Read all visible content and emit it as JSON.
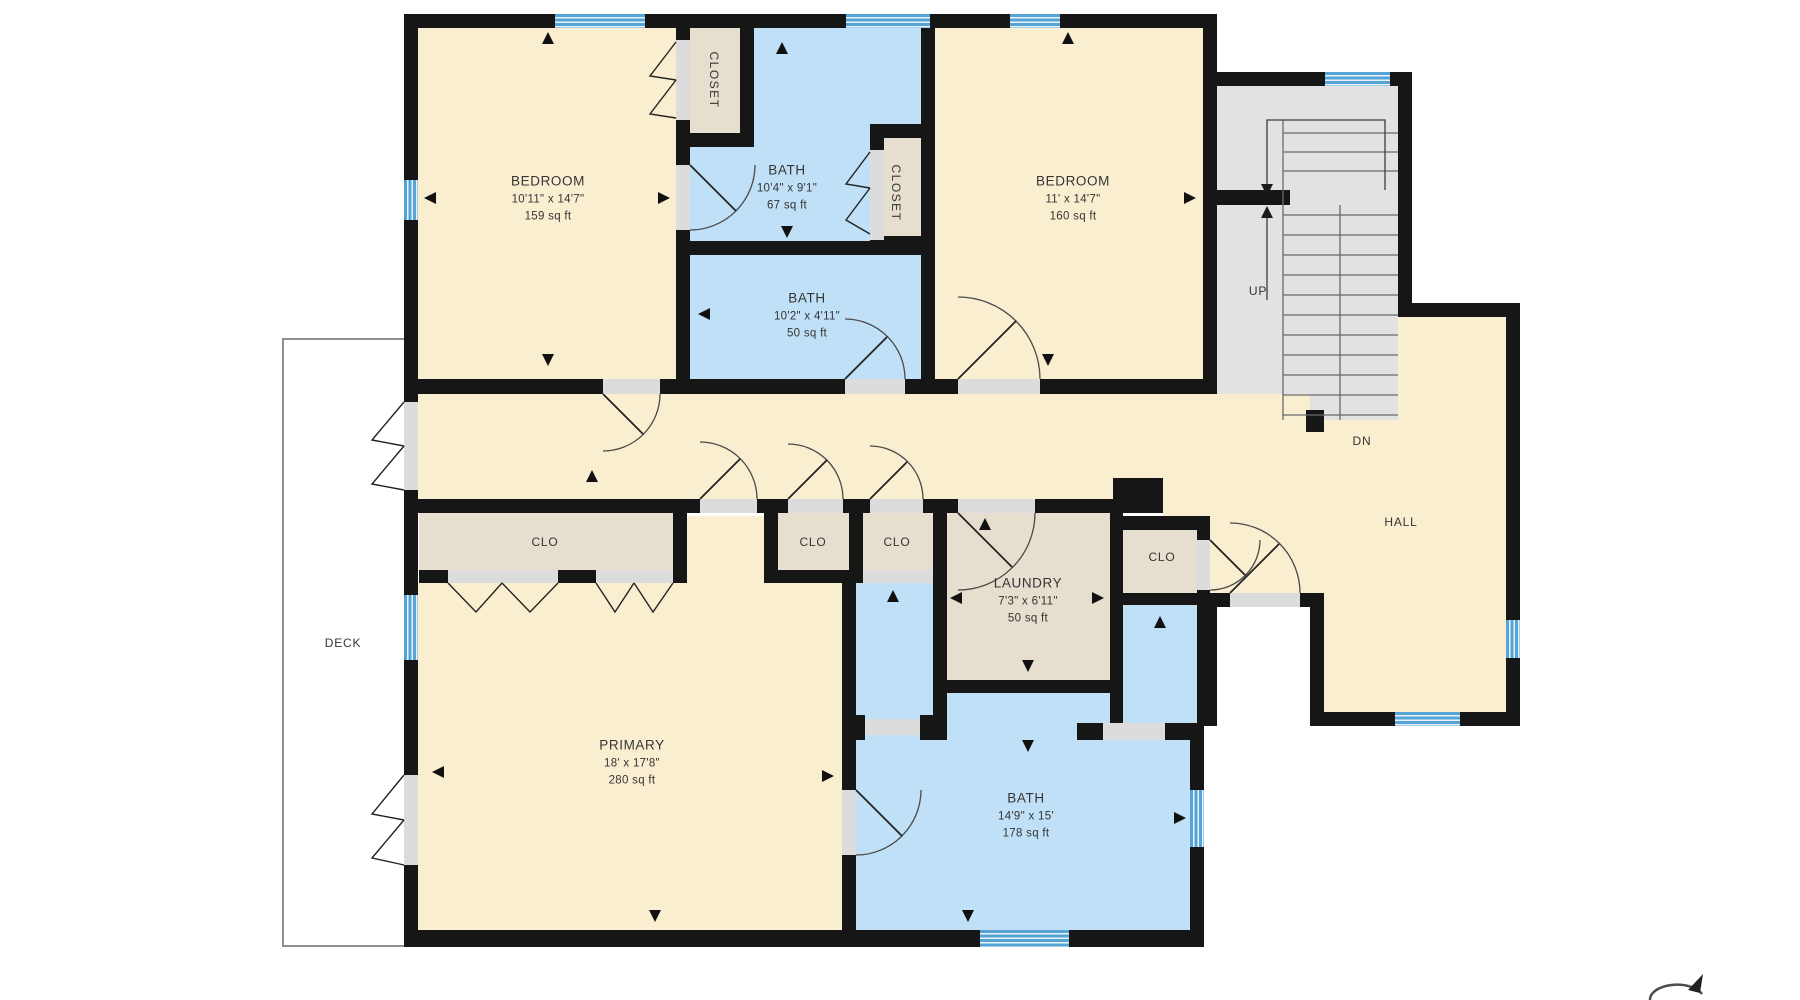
{
  "plan_title": "Second floor plan",
  "rooms": {
    "bedroom1": {
      "name": "BEDROOM",
      "dims": "10'11\" x 14'7\"",
      "area": "159 sq ft"
    },
    "bath1": {
      "name": "BATH",
      "dims": "10'4\" x 9'1\"",
      "area": "67 sq ft"
    },
    "bath2": {
      "name": "BATH",
      "dims": "10'2\" x 4'11\"",
      "area": "50 sq ft"
    },
    "bedroom2": {
      "name": "BEDROOM",
      "dims": "11' x 14'7\"",
      "area": "160 sq ft"
    },
    "primary": {
      "name": "PRIMARY",
      "dims": "18' x 17'8\"",
      "area": "280 sq ft"
    },
    "bath3": {
      "name": "BATH",
      "dims": "14'9\" x 15'",
      "area": "178 sq ft"
    },
    "laundry": {
      "name": "LAUNDRY",
      "dims": "7'3\" x 6'11\"",
      "area": "50 sq ft"
    }
  },
  "closets": {
    "closet_a": {
      "label": "CLOSET"
    },
    "closet_b": {
      "label": "CLOSET"
    },
    "clo_primary": {
      "label": "CLO"
    },
    "clo_1": {
      "label": "CLO"
    },
    "clo_2": {
      "label": "CLO"
    },
    "clo_hall": {
      "label": "CLO"
    }
  },
  "annotations": {
    "up": "UP",
    "dn": "DN",
    "hall": "HALL",
    "deck": "DECK"
  },
  "colors": {
    "wall": "#161616",
    "cream": "#faeed0",
    "blue": "#bfe0f6",
    "beige": "#e6decf",
    "stairs": "#e2e2e2",
    "opening": "#dcdcdc",
    "window": "#56a4d6"
  }
}
